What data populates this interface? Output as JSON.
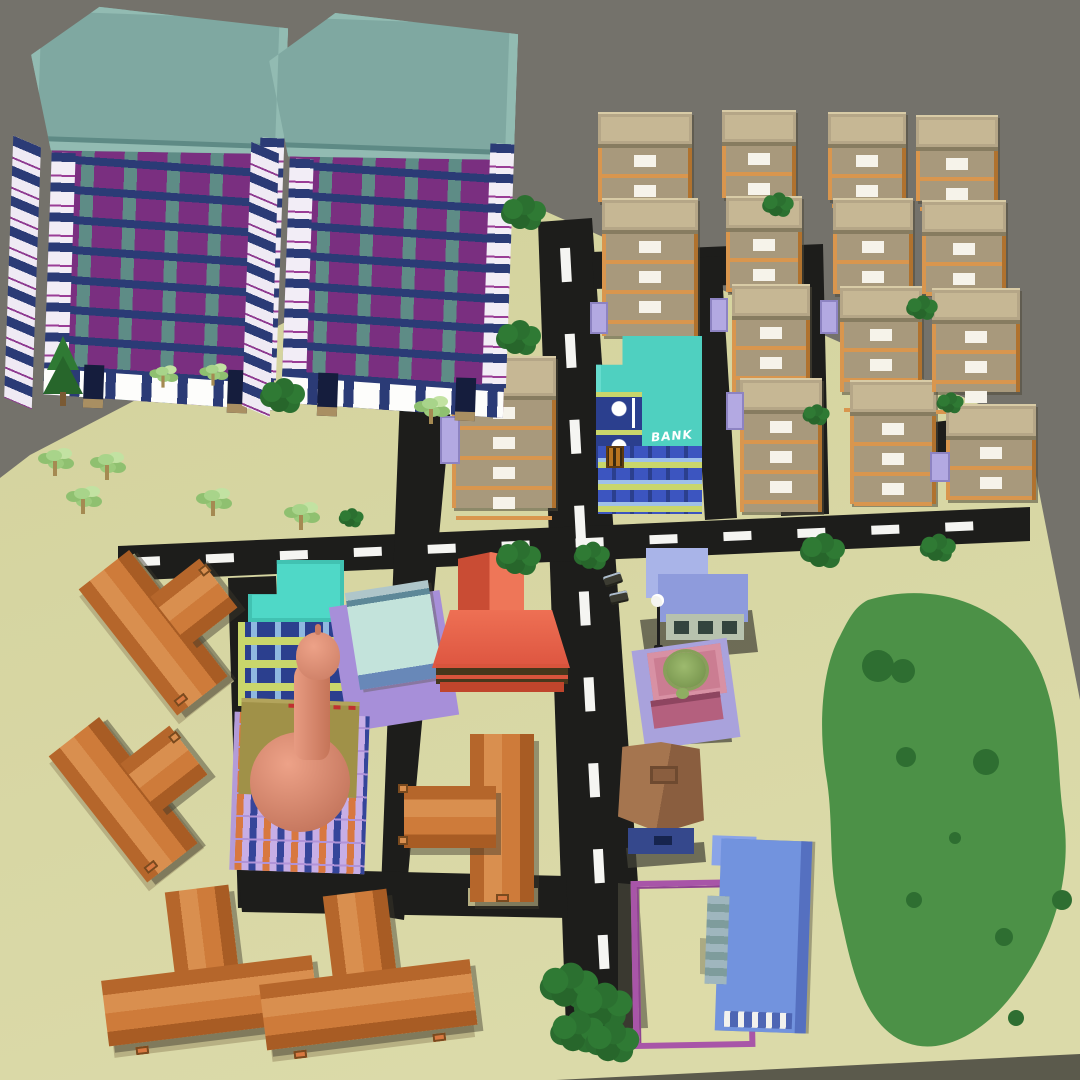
{
  "scene": {
    "type": "3d-low-poly-city-render",
    "bank_sign": "BANK",
    "colors": {
      "sky": "#74726B",
      "ground": "#D6D5A2",
      "ground_side": "#5B5A4C",
      "road": "#1D1D1B",
      "road_marking": "#F5F5F2",
      "park_green": "#4C9147",
      "park_bush": "#2E6E31",
      "tower_roof": "#7FA8A1",
      "tower_wall": "#5E8C86",
      "tower_window": "#7A2F80",
      "tower_slab": "#2B3B76",
      "apartment_wall": "#A8997C",
      "apartment_roof": "#C6B794",
      "apartment_balcony": "#D9964E",
      "apartment_window": "#F6F3EA",
      "awning": "#B3A9E2",
      "bank_roof": "#4FD0C0",
      "bank_wall": "#2B3F8E",
      "bank_trim": "#C9D66B",
      "bank_window_stripe": "#9FC0E8",
      "teal_building_roof": "#4FD8C7",
      "mint_wall": "#C3E3DB",
      "purple_pad": "#A78FD9",
      "red_building_roof": "#E55D45",
      "mosque_base": "#C7AEE6",
      "mosque_deck": "#A09148",
      "mosque_dome": "#D98B72",
      "office_roof": "#98A5E0",
      "fountain_pink": "#CB7D92",
      "fountain_water": "#7E9C53",
      "barn_roof": "#9C6F4C",
      "barn_front": "#35488C",
      "courtyard_wall": "#A855A8",
      "hall_roof": "#7293DE",
      "house_roof": "#CE7B3A",
      "house_base": "#B7B083",
      "tree_dark": "#2F7A34",
      "tree_light": "#A8D48A"
    },
    "objects": [
      {
        "name": "apartment-tower",
        "count": 2
      },
      {
        "name": "tan-apartment-block",
        "count": 15
      },
      {
        "name": "bank-building",
        "count": 1
      },
      {
        "name": "teal-l-building",
        "count": 1
      },
      {
        "name": "mint-building",
        "count": 1
      },
      {
        "name": "red-roof-building",
        "count": 1
      },
      {
        "name": "mosque",
        "count": 1
      },
      {
        "name": "office-building",
        "count": 1
      },
      {
        "name": "fountain-plaza",
        "count": 1
      },
      {
        "name": "street-lamp",
        "count": 1
      },
      {
        "name": "barn",
        "count": 1
      },
      {
        "name": "walled-courtyard",
        "count": 1
      },
      {
        "name": "blue-hall",
        "count": 1
      },
      {
        "name": "orange-house",
        "count": 5
      },
      {
        "name": "park-meadow",
        "count": 1
      },
      {
        "name": "dark-tree",
        "count": 16
      },
      {
        "name": "palm-tree",
        "count": 8
      },
      {
        "name": "pine-tree",
        "count": 1
      },
      {
        "name": "car",
        "count": 2
      }
    ]
  }
}
